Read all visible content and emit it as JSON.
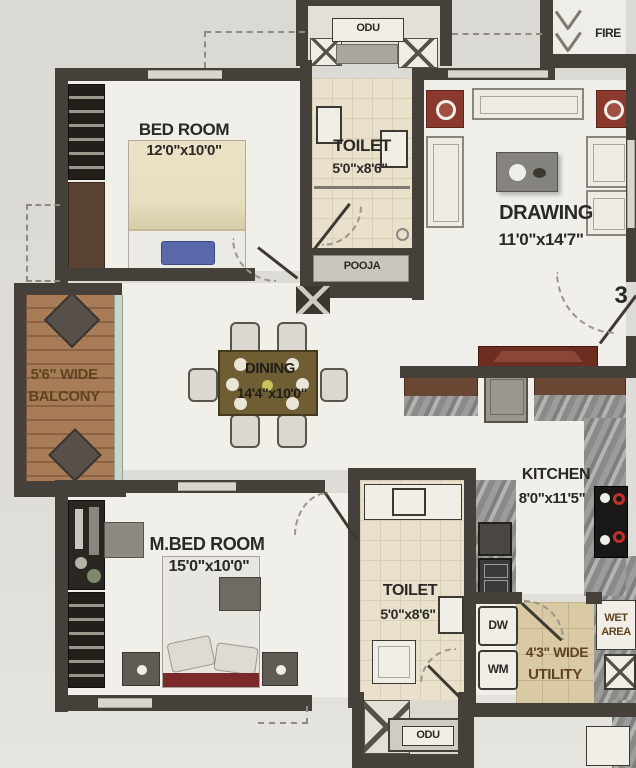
{
  "plan_title": "2BHK apartment floor plan",
  "rooms": {
    "bedroom": {
      "name": "BED ROOM",
      "dims": "12'0\"x10'0\""
    },
    "toilet_top": {
      "name": "TOILET",
      "dims": "5'0\"x8'6\""
    },
    "pooja": {
      "name": "POOJA"
    },
    "odu_top": {
      "name": "ODU"
    },
    "fire": {
      "name": "FIRE"
    },
    "drawing": {
      "name": "DRAWING",
      "dims": "11'0\"x14'7\""
    },
    "balcony": {
      "line1": "5'6\" WIDE",
      "line2": "BALCONY"
    },
    "dining": {
      "name": "DINING",
      "dims": "14'4\"x10'0\""
    },
    "kitchen": {
      "name": "KITCHEN",
      "dims": "8'0\"x11'5\""
    },
    "master_bedroom": {
      "name": "M.BED ROOM",
      "dims": "15'0\"x10'0\""
    },
    "toilet_bottom": {
      "name": "TOILET",
      "dims": "5'0\"x8'6\""
    },
    "utility": {
      "line1": "4'3\" WIDE",
      "line2": "UTILITY"
    },
    "wet_area": {
      "line1": "WET",
      "line2": "AREA"
    },
    "odu_bottom": {
      "name": "ODU"
    },
    "dishwasher": "DW",
    "washing_machine": "WM",
    "entrance_door_number": "3"
  },
  "colors": {
    "wall": "#45413a",
    "floor": "#f1efe9",
    "balcony_wood": "#a97c58",
    "toilet_tile": "#e9e1cc",
    "granite_counter": "#8f8f8d",
    "cabinet_brown": "#6a4733",
    "tv_unit_maroon": "#6d2d20",
    "side_table_red": "#8a3a2c",
    "bed_blanket": "#e7ddc0",
    "pillow_blue": "#5968a8",
    "label_dark": "#2b2925",
    "label_brown": "#5f431f",
    "utility_floor": "#d9caa3"
  }
}
